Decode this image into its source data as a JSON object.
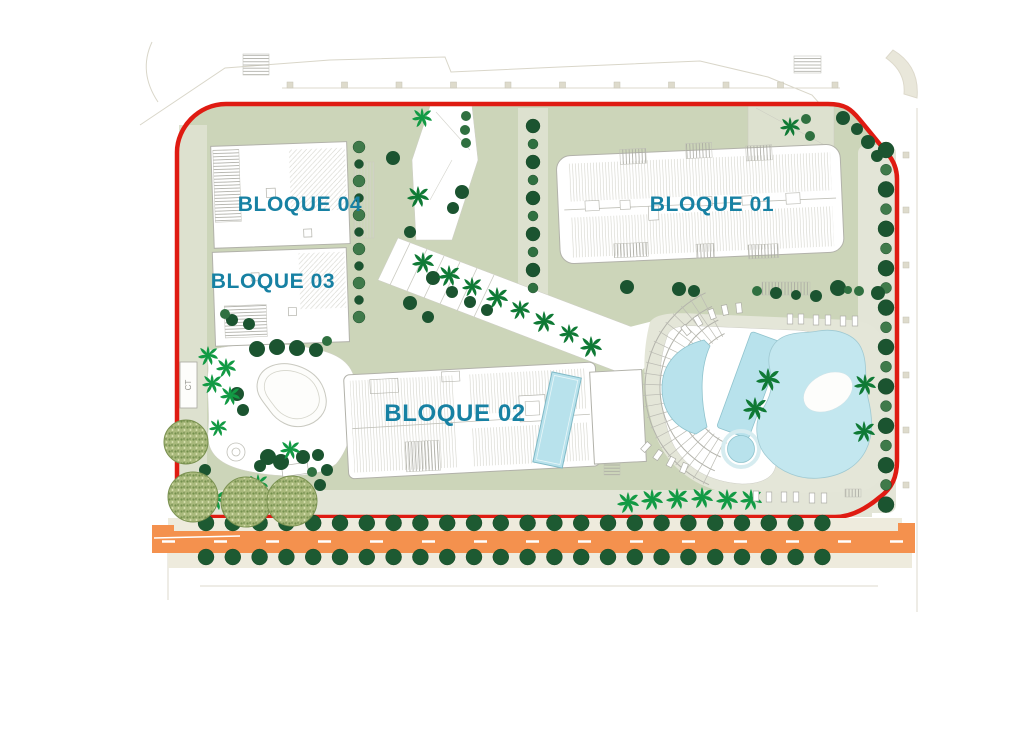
{
  "plan": {
    "labels": {
      "bloque01": "BLOQUE 01",
      "bloque02": "BLOQUE 02",
      "bloque03": "BLOQUE 03",
      "bloque04": "BLOQUE 04",
      "ct": "CT"
    },
    "colors": {
      "boundary_red": "#df1b12",
      "road_orange": "#f4914e",
      "label_teal": "#1781a3",
      "site_green": "#ccd5b9",
      "pool_blue": "#b8e2ec",
      "lagoon_blue": "#c3e7ef",
      "tree_dark": "#1b5430",
      "palm_green": "#129a44"
    }
  },
  "tree_rows": [
    {
      "name": "street-top",
      "axis": "h",
      "x_start": 206,
      "y": 523,
      "step": 26.8,
      "count": 24,
      "r": 8,
      "color": "#1d5a32"
    },
    {
      "name": "street-bottom",
      "axis": "h",
      "x_start": 206,
      "y": 557,
      "step": 26.8,
      "count": 24,
      "r": 8,
      "color": "#1d5a32"
    },
    {
      "name": "right-column",
      "axis": "v",
      "x": 886,
      "y_start": 150,
      "step": 19.7,
      "count": 19,
      "r": [
        8,
        5.5
      ],
      "color": [
        "#1b5430",
        "#3f7a4a"
      ]
    },
    {
      "name": "mid-column",
      "axis": "v",
      "x": 533,
      "y_start": 126,
      "step": 18,
      "count": 10,
      "r": [
        7,
        5
      ],
      "color": [
        "#1b5430",
        "#2f7040"
      ]
    },
    {
      "name": "inner-column",
      "axis": "v",
      "x": 359,
      "y_start": 147,
      "step": 17,
      "count": 11,
      "r": [
        6,
        4.5
      ],
      "color": [
        "#3f7a4a",
        "#1b5430"
      ]
    }
  ],
  "trees": [
    [
      393,
      158,
      7,
      "#1b5430"
    ],
    [
      462,
      192,
      7,
      "#1b5430"
    ],
    [
      453,
      208,
      6,
      "#1b5430"
    ],
    [
      410,
      232,
      6,
      "#1b5430"
    ],
    [
      410,
      303,
      7,
      "#1b5430"
    ],
    [
      428,
      317,
      6,
      "#1b5430"
    ],
    [
      466,
      116,
      5,
      "#2f7040"
    ],
    [
      465,
      130,
      5,
      "#2f7040"
    ],
    [
      466,
      143,
      5,
      "#2f7040"
    ],
    [
      806,
      119,
      5,
      "#2f7040"
    ],
    [
      810,
      136,
      5,
      "#2f7040"
    ],
    [
      843,
      118,
      7,
      "#1b5430"
    ],
    [
      857,
      129,
      6,
      "#1b5430"
    ],
    [
      868,
      142,
      7,
      "#1b5430"
    ],
    [
      877,
      156,
      6,
      "#1b5430"
    ],
    [
      433,
      278,
      7,
      "#1b5430"
    ],
    [
      452,
      292,
      6,
      "#1b5430"
    ],
    [
      470,
      302,
      6,
      "#1b5430"
    ],
    [
      487,
      310,
      6,
      "#1b5430"
    ],
    [
      627,
      287,
      7,
      "#1b5430"
    ],
    [
      679,
      289,
      7,
      "#1b5430"
    ],
    [
      694,
      291,
      6,
      "#1b5430"
    ],
    [
      757,
      291,
      5,
      "#2f7040"
    ],
    [
      776,
      293,
      6,
      "#1b5430"
    ],
    [
      796,
      295,
      5,
      "#1b5430"
    ],
    [
      816,
      296,
      6,
      "#1b5430"
    ],
    [
      838,
      288,
      8,
      "#1b5430"
    ],
    [
      848,
      290,
      4,
      "#2f7040"
    ],
    [
      859,
      291,
      5,
      "#2f7040"
    ],
    [
      878,
      293,
      7,
      "#1b5430"
    ],
    [
      257,
      349,
      8,
      "#1b5430"
    ],
    [
      277,
      347,
      8,
      "#1b5430"
    ],
    [
      297,
      348,
      8,
      "#1b5430"
    ],
    [
      316,
      350,
      7,
      "#1b5430"
    ],
    [
      327,
      341,
      5,
      "#2f7040"
    ],
    [
      268,
      457,
      8,
      "#1b5430"
    ],
    [
      281,
      462,
      8,
      "#1b5430"
    ],
    [
      260,
      466,
      6,
      "#1b5430"
    ],
    [
      303,
      457,
      7,
      "#1b5430"
    ],
    [
      318,
      455,
      6,
      "#1b5430"
    ],
    [
      327,
      470,
      6,
      "#1b5430"
    ],
    [
      320,
      485,
      6,
      "#1b5430"
    ],
    [
      312,
      472,
      5,
      "#2f7040"
    ],
    [
      232,
      320,
      6,
      "#1b5430"
    ],
    [
      249,
      324,
      6,
      "#1b5430"
    ],
    [
      225,
      314,
      5,
      "#2f7040"
    ],
    [
      237,
      394,
      7,
      "#1b5430"
    ],
    [
      243,
      410,
      6,
      "#1b5430"
    ],
    [
      205,
      470,
      6,
      "#1b5430"
    ]
  ],
  "palms": [
    [
      422,
      118,
      10,
      "#129a44"
    ],
    [
      418,
      197,
      11,
      "#0f7a35"
    ],
    [
      790,
      127,
      10,
      "#0f7a35"
    ],
    [
      423,
      263,
      11,
      "#0f7a35"
    ],
    [
      449,
      276,
      11,
      "#0f7a35"
    ],
    [
      472,
      287,
      10,
      "#0f7a35"
    ],
    [
      497,
      298,
      11,
      "#0f7a35"
    ],
    [
      520,
      310,
      10,
      "#0f7a35"
    ],
    [
      544,
      322,
      11,
      "#0f7a35"
    ],
    [
      569,
      334,
      10,
      "#0f7a35"
    ],
    [
      591,
      347,
      11,
      "#0f7a35"
    ],
    [
      768,
      380,
      12,
      "#0f7a35"
    ],
    [
      755,
      409,
      12,
      "#0f7a35"
    ],
    [
      865,
      385,
      11,
      "#0f7a35"
    ],
    [
      864,
      432,
      11,
      "#0f7a35"
    ],
    [
      628,
      503,
      11,
      "#129a44"
    ],
    [
      652,
      500,
      11,
      "#129a44"
    ],
    [
      677,
      499,
      11,
      "#129a44"
    ],
    [
      702,
      498,
      11,
      "#129a44"
    ],
    [
      727,
      500,
      11,
      "#129a44"
    ],
    [
      751,
      500,
      11,
      "#129a44"
    ],
    [
      208,
      356,
      10,
      "#129a44"
    ],
    [
      226,
      368,
      10,
      "#129a44"
    ],
    [
      212,
      384,
      10,
      "#129a44"
    ],
    [
      230,
      396,
      10,
      "#129a44"
    ],
    [
      218,
      428,
      9,
      "#129a44"
    ],
    [
      215,
      500,
      11,
      "#129a44"
    ],
    [
      258,
      484,
      10,
      "#129a44"
    ],
    [
      290,
      450,
      10,
      "#129a44"
    ]
  ],
  "speckled": [
    [
      186,
      442,
      22
    ],
    [
      193,
      497,
      25
    ],
    [
      246,
      502,
      25
    ],
    [
      292,
      501,
      25
    ]
  ],
  "furniture": {
    "sunbeds": [
      [
        712,
        314,
        -20
      ],
      [
        725,
        310,
        -12
      ],
      [
        739,
        308,
        -6
      ],
      [
        698,
        321,
        -30
      ],
      [
        686,
        330,
        -38
      ],
      [
        790,
        319,
        0
      ],
      [
        801,
        319,
        0
      ],
      [
        816,
        320,
        0
      ],
      [
        828,
        320,
        0
      ],
      [
        843,
        321,
        0
      ],
      [
        855,
        321,
        0
      ],
      [
        646,
        447,
        42
      ],
      [
        658,
        455,
        35
      ],
      [
        671,
        462,
        28
      ],
      [
        684,
        468,
        22
      ],
      [
        756,
        496,
        0
      ],
      [
        769,
        497,
        0
      ],
      [
        784,
        497,
        0
      ],
      [
        796,
        497,
        0
      ],
      [
        812,
        498,
        0
      ],
      [
        824,
        498,
        0
      ]
    ]
  },
  "amphitheater": {
    "cx": 750,
    "cy": 388,
    "radii": [
      60,
      75,
      90,
      105
    ],
    "a1": 115,
    "a2": 248,
    "tick_step": 6,
    "tick_r1": 58,
    "tick_r2": 107
  },
  "lamp_rows": [
    {
      "axis": "h",
      "x_start": 290,
      "y": 85,
      "step": 54.5,
      "count": 11
    },
    {
      "axis": "v",
      "x": 906,
      "y_start": 155,
      "step": 55,
      "count": 7
    }
  ]
}
